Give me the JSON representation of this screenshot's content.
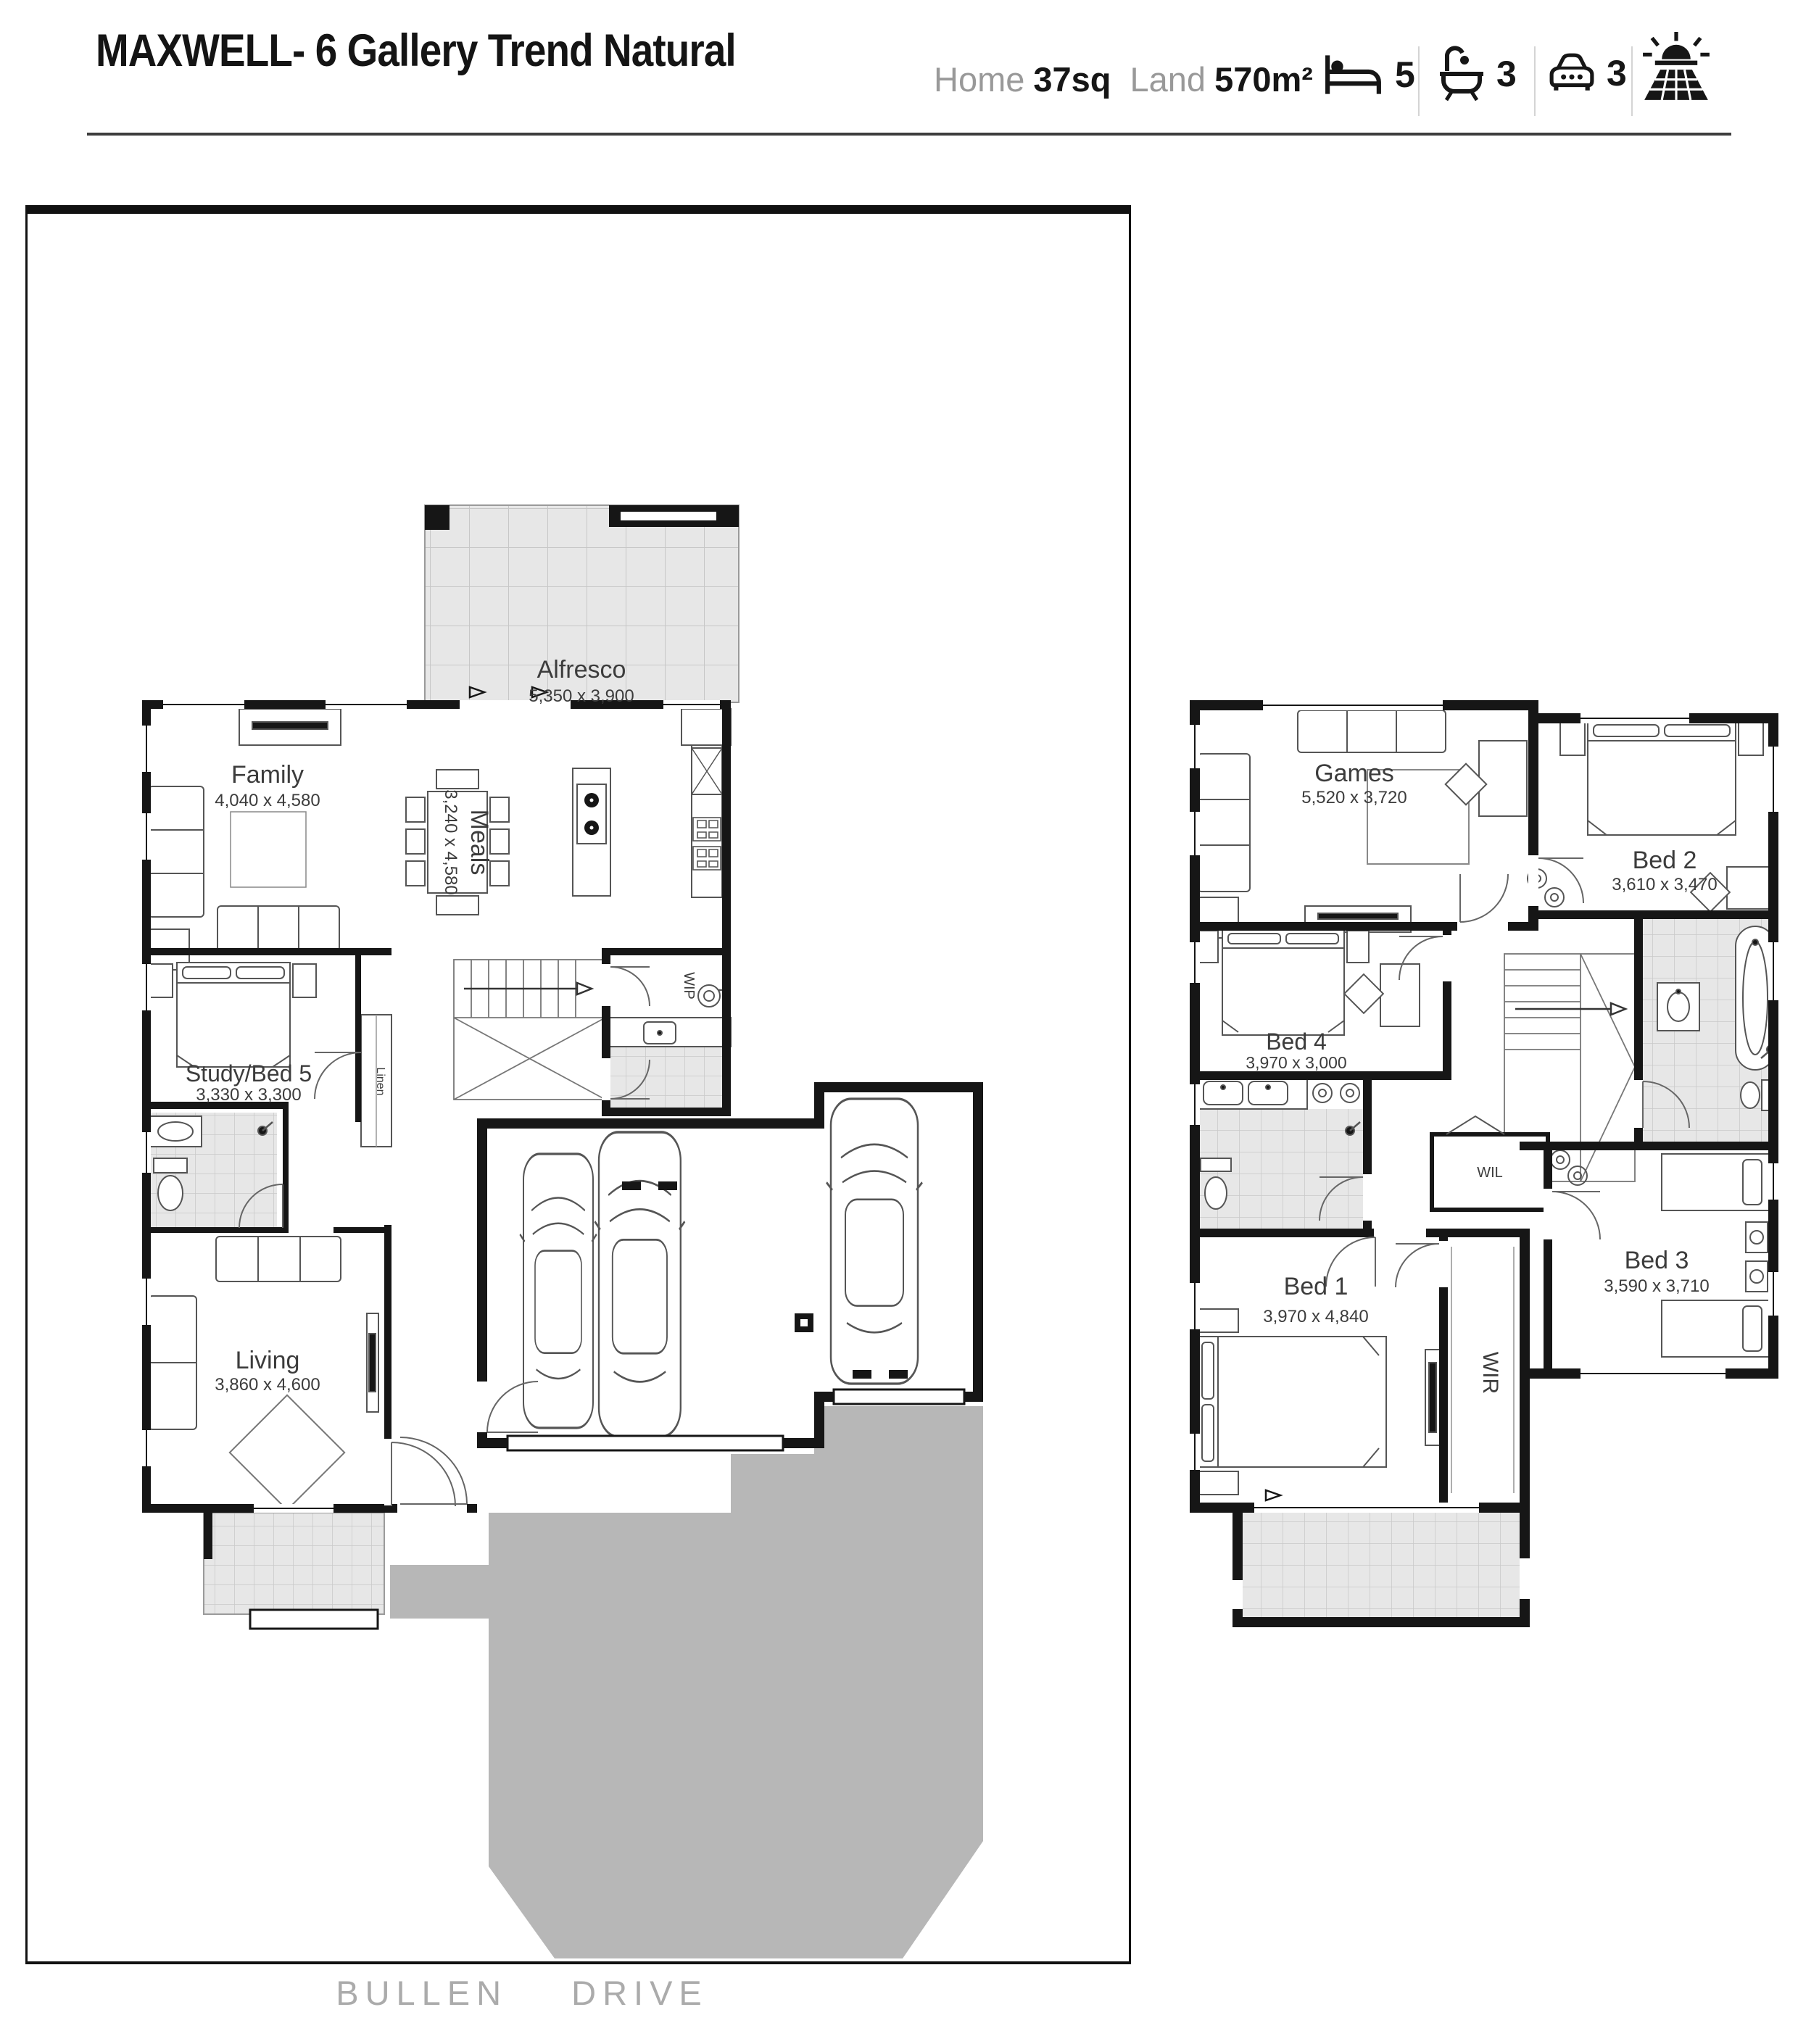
{
  "header": {
    "title": "MAXWELL- 6 Gallery Trend Natural",
    "home_label": "Home",
    "home_value": "37sq",
    "land_label": "Land",
    "land_value": "570m²",
    "icons": [
      {
        "icon": "bed-icon",
        "count": "5"
      },
      {
        "icon": "bath-icon",
        "count": "3"
      },
      {
        "icon": "car-icon",
        "count": "3"
      },
      {
        "icon": "solar-panel-icon",
        "count": ""
      }
    ],
    "accent_color": "#161616",
    "muted_color": "#999999"
  },
  "ground_floor": {
    "rooms": {
      "alfresco": {
        "name": "Alfresco",
        "dims": "5,350 x 3,900"
      },
      "family": {
        "name": "Family",
        "dims": "4,040 x 4,580"
      },
      "meals": {
        "name": "Meals",
        "dims": "3,240 x 4,580"
      },
      "study": {
        "name": "Study/Bed 5",
        "dims": "3,330 x 3,300"
      },
      "living": {
        "name": "Living",
        "dims": "3,860 x 4,600"
      },
      "wip": {
        "name": "WIP"
      },
      "linen": {
        "name": "Linen"
      }
    },
    "street": "BULLEN DRIVE"
  },
  "first_floor": {
    "rooms": {
      "games": {
        "name": "Games",
        "dims": "5,520 x 3,720"
      },
      "bed2": {
        "name": "Bed 2",
        "dims": "3,610 x 3,470"
      },
      "bed4": {
        "name": "Bed 4",
        "dims": "3,970 x 3,000"
      },
      "bed1": {
        "name": "Bed 1",
        "dims": "3,970 x 4,840"
      },
      "bed3": {
        "name": "Bed 3",
        "dims": "3,590 x 3,710"
      },
      "wil": {
        "name": "WIL"
      },
      "wir": {
        "name": "WIR"
      }
    }
  }
}
